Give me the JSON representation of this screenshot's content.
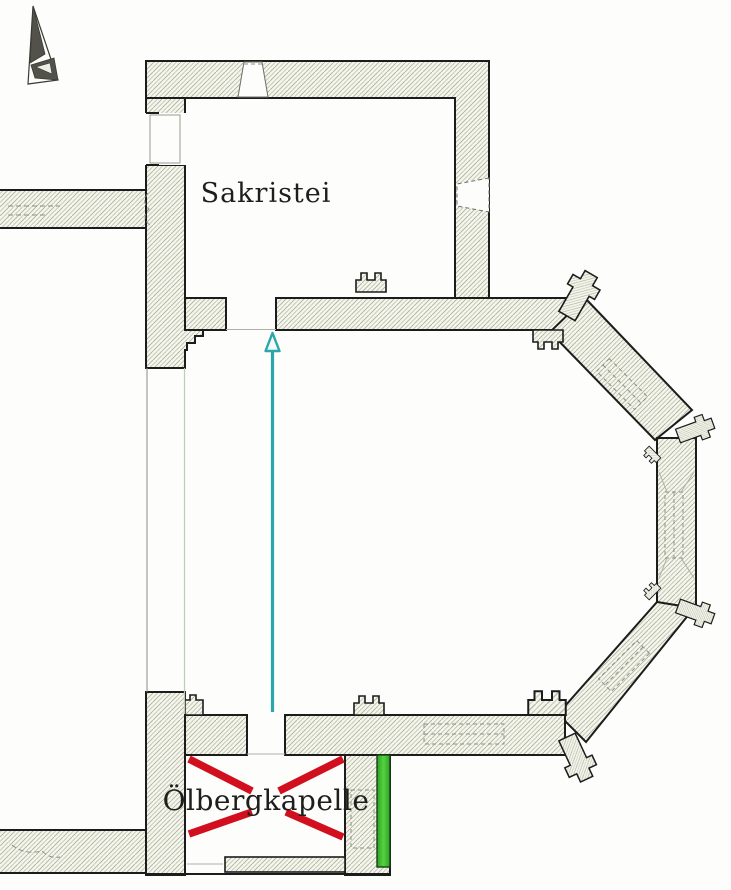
{
  "plan": {
    "type": "church-floor-plan",
    "rooms": {
      "sacristy_label": "Sakristei",
      "chapel_label": "Ölbergkapelle"
    },
    "annotations": {
      "route_arrow": "vertical arrow pointing north from chapel doorway to sacristy doorway",
      "demolished_cross": "red X drawn across the Ölbergkapelle room",
      "entrance_bar": "green bar marking wall segment east of the chapel",
      "north_arrow": "compass needle, top-left"
    },
    "colors": {
      "route_arrow": "#2ba6ab",
      "route_arrow_head_fill": "#f2fafa",
      "demolished_cross": "#d20f1e",
      "entrance_bar": "#33b733",
      "entrance_bar_edge": "#154d15",
      "wall_outline": "#1c1c1c",
      "hatch_gray": "#aeaea2",
      "hatch_green": "#b7cdb2",
      "north_arrow_dark": "#52524b"
    }
  }
}
